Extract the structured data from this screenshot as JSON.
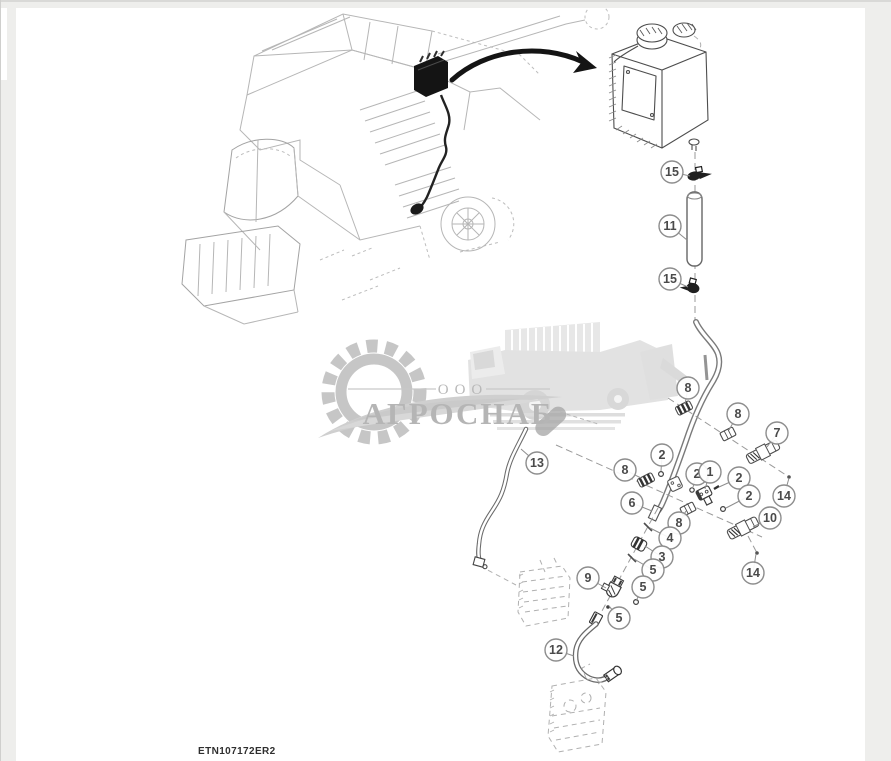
{
  "page": {
    "drawing_number": "ETN107172ER2",
    "colors": {
      "outer_bg": "#eeeeec",
      "canvas": "#ffffff",
      "sketch_line": "#b6b6b6",
      "part_line": "#4d4d4d",
      "highlight_black": "#141414",
      "balloon_stroke": "#8d8d8d",
      "balloon_text": "#4a4a4a",
      "watermark_gray": "#bdbdbd"
    }
  },
  "watermark": {
    "org_type": "ООО",
    "org_name": "АГРОСНАБ"
  },
  "callouts": [
    {
      "label": "15",
      "x": 672,
      "y": 172,
      "tx": 690,
      "ty": 176
    },
    {
      "label": "11",
      "x": 670,
      "y": 226,
      "tx": 687,
      "ty": 240
    },
    {
      "label": "15",
      "x": 670,
      "y": 279,
      "tx": 688,
      "ty": 287
    },
    {
      "label": "8",
      "x": 688,
      "y": 388,
      "tx": 685,
      "ty": 404
    },
    {
      "label": "8",
      "x": 738,
      "y": 414,
      "tx": 729,
      "ty": 430
    },
    {
      "label": "7",
      "x": 777,
      "y": 433,
      "tx": 767,
      "ty": 447
    },
    {
      "label": "2",
      "x": 662,
      "y": 455,
      "tx": 661,
      "ty": 471
    },
    {
      "label": "8",
      "x": 625,
      "y": 470,
      "tx": 641,
      "ty": 478
    },
    {
      "label": "2",
      "x": 697,
      "y": 474,
      "tx": 693,
      "ty": 487
    },
    {
      "label": "1",
      "x": 710,
      "y": 472,
      "tx": 705,
      "ty": 489
    },
    {
      "label": "2",
      "x": 739,
      "y": 478,
      "tx": 719,
      "ty": 487
    },
    {
      "label": "2",
      "x": 749,
      "y": 496,
      "tx": 726,
      "ty": 508
    },
    {
      "label": "14",
      "x": 784,
      "y": 496,
      "tx": 789,
      "ty": 478
    },
    {
      "label": "6",
      "x": 632,
      "y": 503,
      "tx": 652,
      "ty": 511
    },
    {
      "label": "8",
      "x": 679,
      "y": 523,
      "tx": 686,
      "ty": 511
    },
    {
      "label": "10",
      "x": 770,
      "y": 518,
      "tx": 753,
      "ty": 527
    },
    {
      "label": "4",
      "x": 670,
      "y": 538,
      "tx": 650,
      "ty": 528
    },
    {
      "label": "3",
      "x": 662,
      "y": 557,
      "tx": 645,
      "ty": 546
    },
    {
      "label": "5",
      "x": 653,
      "y": 570,
      "tx": 634,
      "ty": 559
    },
    {
      "label": "14",
      "x": 753,
      "y": 573,
      "tx": 756,
      "ty": 554
    },
    {
      "label": "9",
      "x": 588,
      "y": 578,
      "tx": 606,
      "ty": 588
    },
    {
      "label": "5",
      "x": 643,
      "y": 587,
      "tx": 636,
      "ty": 601
    },
    {
      "label": "5",
      "x": 619,
      "y": 618,
      "tx": 609,
      "ty": 606
    },
    {
      "label": "12",
      "x": 556,
      "y": 650,
      "tx": 574,
      "ty": 656
    },
    {
      "label": "13",
      "x": 537,
      "y": 463,
      "tx": 521,
      "ty": 449
    }
  ]
}
